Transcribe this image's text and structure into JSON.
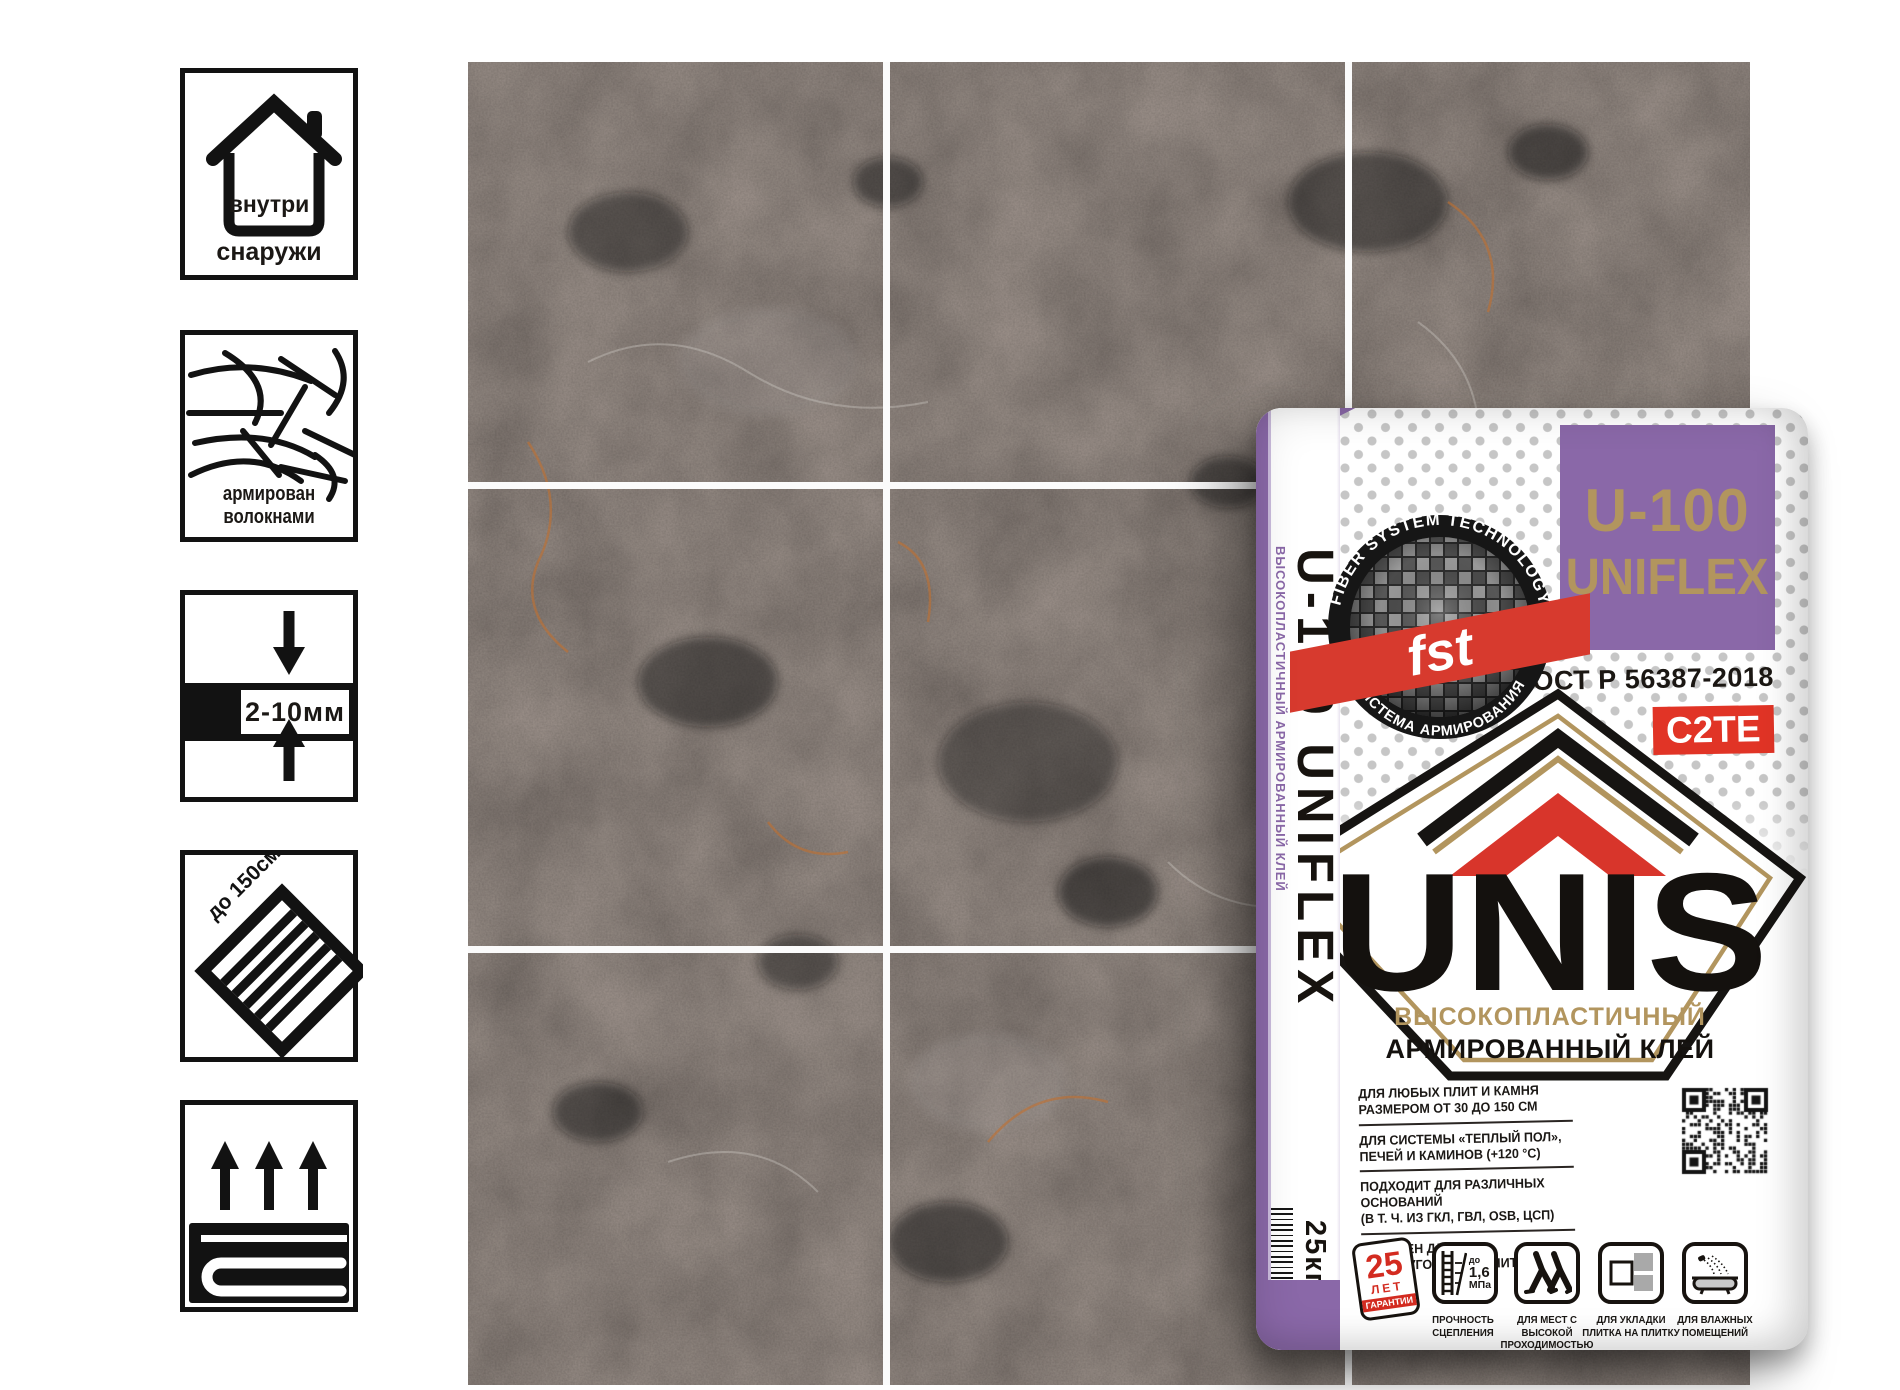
{
  "colors": {
    "purple": "#8a68a8",
    "gold": "#b2955e",
    "red": "#dd3428",
    "dark": "#1c1917",
    "dot_gray": "#c6c6c6"
  },
  "left_icons": {
    "indoor_outdoor": {
      "inside": "внутри",
      "below": "снаружи"
    },
    "fiber": {
      "label": "армирован волокнами"
    },
    "thickness": {
      "label": "2-10мм"
    },
    "tile_size": {
      "label": "до 150см"
    }
  },
  "bag": {
    "gusset": {
      "small_text": "ВЫСОКОПЛАСТИЧНЫЙ АРМИРОВАННЫЙ КЛЕЙ",
      "product": "U-100 UNIFLEX",
      "weight": "25кг"
    },
    "badge": {
      "arc_top": "FIBER SYSTEM TECHNOLOGY",
      "ribbon": "fst",
      "arc_bottom": "СИСТЕМА АРМИРОВАНИЯ"
    },
    "panel": {
      "line1": "U-100",
      "line2": "UNIFLEX"
    },
    "gost": "ГОСТ Р 56387-2018",
    "class_badge": "C2TE",
    "brand": "UNIS",
    "subtitle_gold": "ВЫСОКОПЛАСТИЧНЫЙ",
    "subtitle_black": "АРМИРОВАННЫЙ КЛЕЙ",
    "features": [
      {
        "l1": "ДЛЯ ЛЮБЫХ ПЛИТ И КАМНЯ",
        "l2": "РАЗМЕРОМ ОТ 30 ДО 150 СМ"
      },
      {
        "l1": "ДЛЯ СИСТЕМЫ «ТЕПЛЫЙ ПОЛ»,",
        "l2": "ПЕЧЕЙ И КАМИНОВ (+120 °С)"
      },
      {
        "l1": "ПОДХОДИТ ДЛЯ РАЗЛИЧНЫХ ОСНОВАНИЙ",
        "l2": "(В Т. Ч. ИЗ ГКЛ, ГВЛ, OSB, ЦСП)"
      },
      {
        "l1": "ИДЕАЛЕН ДЛЯ ПРЯМОУГОЛЬНЫХ ПЛИТ",
        "l2": ""
      }
    ],
    "guarantee": {
      "years": "25",
      "unit": "ЛЕТ",
      "label": "ГАРАНТИИ"
    },
    "strength": {
      "prefix": "до",
      "value": "1,6",
      "unit": "МПа",
      "label": "ПРОЧНОСТЬ СЦЕПЛЕНИЯ"
    },
    "traffic": {
      "label": "ДЛЯ МЕСТ С ВЫСОКОЙ ПРОХОДИМОСТЬЮ"
    },
    "tile_on_tile": {
      "label": "ДЛЯ УКЛАДКИ ПЛИТКА НА ПЛИТКУ"
    },
    "wet": {
      "label": "ДЛЯ ВЛАЖНЫХ ПОМЕЩЕНИЙ"
    }
  }
}
